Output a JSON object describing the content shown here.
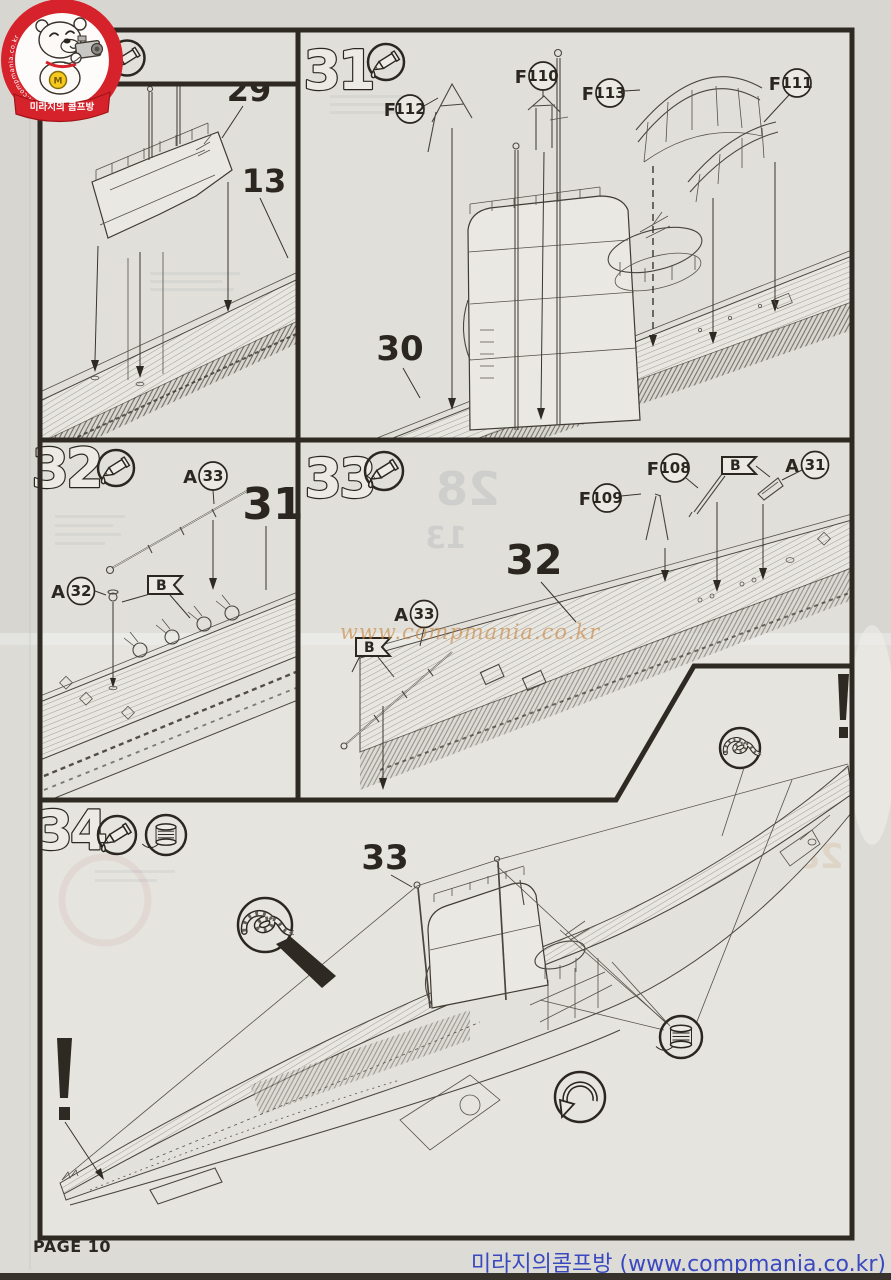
{
  "colors": {
    "ink": "#2e2922",
    "line": "#4a453e",
    "logo_red": "#d6232b",
    "footer_blue": "#3a49c0",
    "watermark_orange": "#c8843c",
    "paper": "#e4e3df"
  },
  "logo": {
    "ribbon_text": "미라지의 콤프방",
    "ring_text": "www.compmania.co.kr",
    "medal_letter": "M"
  },
  "watermark_text": "www.compmania.co.kr",
  "footer": {
    "page_label": "PAGE 10",
    "site_credit": "미라지의콤프방 (www.compmania.co.kr)"
  },
  "icons": {
    "glue": "glue-tube-icon",
    "spool": "thread-spool-icon",
    "knot": "rope-knot-icon",
    "turn": "turn-part-arrow-icon",
    "warning": "exclamation-icon"
  },
  "panels": {
    "pA": {
      "part29": "29",
      "part13": "13"
    },
    "p31": {
      "step": "31",
      "part30": "30",
      "f112_pre": "F",
      "f112": "112",
      "f110_pre": "F",
      "f110": "110",
      "f113_pre": "F",
      "f113": "113",
      "f111_pre": "F",
      "f111": "111"
    },
    "p32": {
      "step": "32",
      "part31": "31",
      "a33_pre": "A",
      "a33": "33",
      "a32_pre": "A",
      "a32": "32",
      "flag_b": "B"
    },
    "p33": {
      "step": "33",
      "part32": "32",
      "f109_pre": "F",
      "f109": "109",
      "f108_pre": "F",
      "f108": "108",
      "a31_pre": "A",
      "a31": "31",
      "a33_pre": "A",
      "a33": "33",
      "flag_b_top": "B",
      "flag_b_left": "B"
    },
    "p34": {
      "step": "34",
      "part33": "33"
    }
  },
  "ghosts": {
    "g28": "28",
    "g13": "13",
    "g28b": "28"
  }
}
